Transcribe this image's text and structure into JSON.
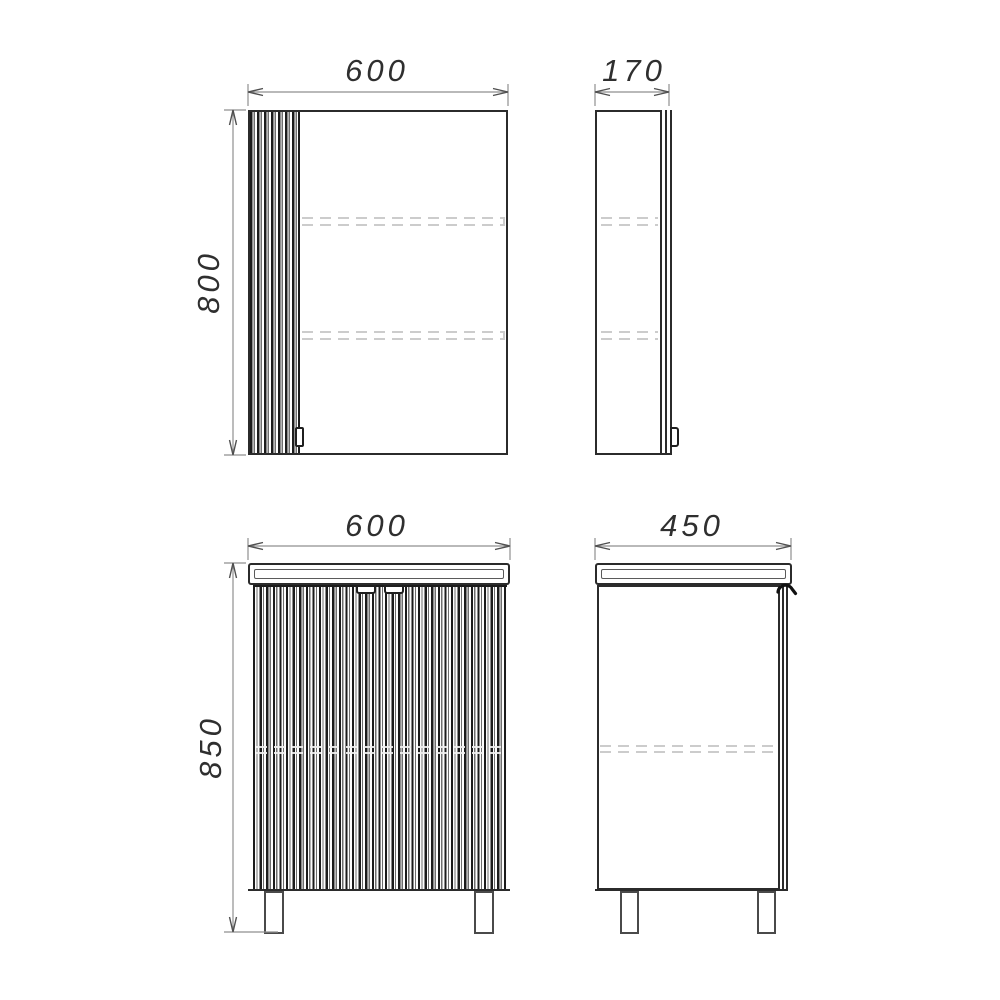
{
  "dimensions": {
    "mirror_front_width": "600",
    "mirror_front_height": "800",
    "mirror_side_depth": "170",
    "vanity_front_width": "600",
    "vanity_front_height": "850",
    "vanity_side_depth": "450"
  },
  "colors": {
    "outline": "#2b2b2b",
    "dimension_line": "#8f8f8f",
    "hidden_shelf_line": "#cccccc",
    "background": "#ffffff"
  }
}
